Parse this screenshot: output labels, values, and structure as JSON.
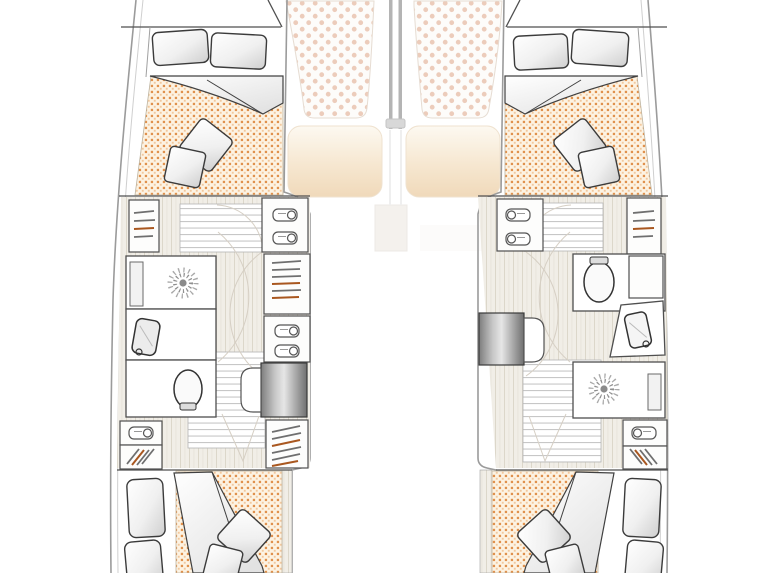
{
  "meta": {
    "title": "Catamaran interior floor plan",
    "view": "top-down deck / accommodation plan",
    "visible_text": [],
    "description": "Two symmetric hulls each containing a forward double cabin, a head compartment (toilet, shower with drain, washbasin), wardrobes with clothes hangers, lockers with rolled towels, companionway stairs, and an aft double cabin. Bow area has two trampoline nets, a forebeam and two beige foredeck cushions."
  },
  "palette": {
    "background": "#ffffff",
    "hull_outline": "#9b9b9b",
    "wall_stroke": "#4f4f4f",
    "mattress_base": "#fdf3e3",
    "mattress_dot_dark": "#e0914d",
    "mattress_dot_light": "#f2c89d",
    "trampoline_base": "#fdfcfa",
    "trampoline_dot": "#ecccbb",
    "wood_floor": "#f1eee7",
    "wood_grain": "#dcd7ca",
    "step_line": "#c7c7c7",
    "cushion_beige": "#f0d9ba",
    "stairs_gray": "#808080",
    "pillow_fill": "#f4f4f4",
    "hanger_gray": "#6f6f6f",
    "hanger_orange": "#a9571f"
  },
  "bow": {
    "items": [
      {
        "name": "port-trampoline-net",
        "pattern": "dotted netting"
      },
      {
        "name": "starboard-trampoline-net",
        "pattern": "dotted netting"
      },
      {
        "name": "forebeam",
        "style": "double gray beam"
      },
      {
        "name": "port-foredeck-cushion",
        "style": "beige rounded pad"
      },
      {
        "name": "starboard-foredeck-cushion",
        "style": "beige rounded pad"
      }
    ]
  },
  "port_hull": {
    "label": "Port hull (left)",
    "forward_cabin": {
      "label": "Forward double cabin",
      "items": [
        "head pillow x2",
        "folded duvet",
        "orange dotted mattress",
        "throw pillow x2"
      ]
    },
    "midship": {
      "label": "Head & dressing area",
      "items": [
        "wardrobe with hangers (fwd, outboard)",
        "entry steps",
        "locker with towels (fwd, inboard)",
        "wardrobe with hangers (mid, inboard)",
        "locker with towels (aft, inboard)",
        "shower with drain and bench",
        "washbasin vanity",
        "toilet compartment",
        "companionway stairs (gray)",
        "rounded landing seat",
        "aft towel locker (outboard)",
        "aft wardrobe (outboard)",
        "aft wardrobe with hangers (inboard)"
      ]
    },
    "aft_cabin": {
      "label": "Aft double cabin",
      "items": [
        "head pillow x2",
        "folded duvet wedge",
        "orange dotted mattress",
        "throw pillow x2"
      ]
    }
  },
  "starboard_hull": {
    "label": "Starboard hull (right)",
    "forward_cabin": {
      "label": "Forward double cabin",
      "items": [
        "head pillow x2",
        "folded duvet",
        "orange dotted mattress",
        "throw pillow x2"
      ]
    },
    "midship": {
      "label": "Head & dressing area",
      "items": [
        "locker with towels (fwd, inboard)",
        "entry steps",
        "wardrobe with hangers (fwd, outboard)",
        "toilet compartment",
        "small closet",
        "washbasin vanity (angled)",
        "companionway stairs (gray)",
        "rounded landing seat",
        "shower with drain and bench",
        "aft towel locker (outboard)",
        "aft wardrobe (outboard)"
      ]
    },
    "aft_cabin": {
      "label": "Aft double cabin",
      "items": [
        "head pillow x2",
        "folded duvet wedge",
        "orange dotted mattress",
        "throw pillow x2"
      ]
    }
  }
}
